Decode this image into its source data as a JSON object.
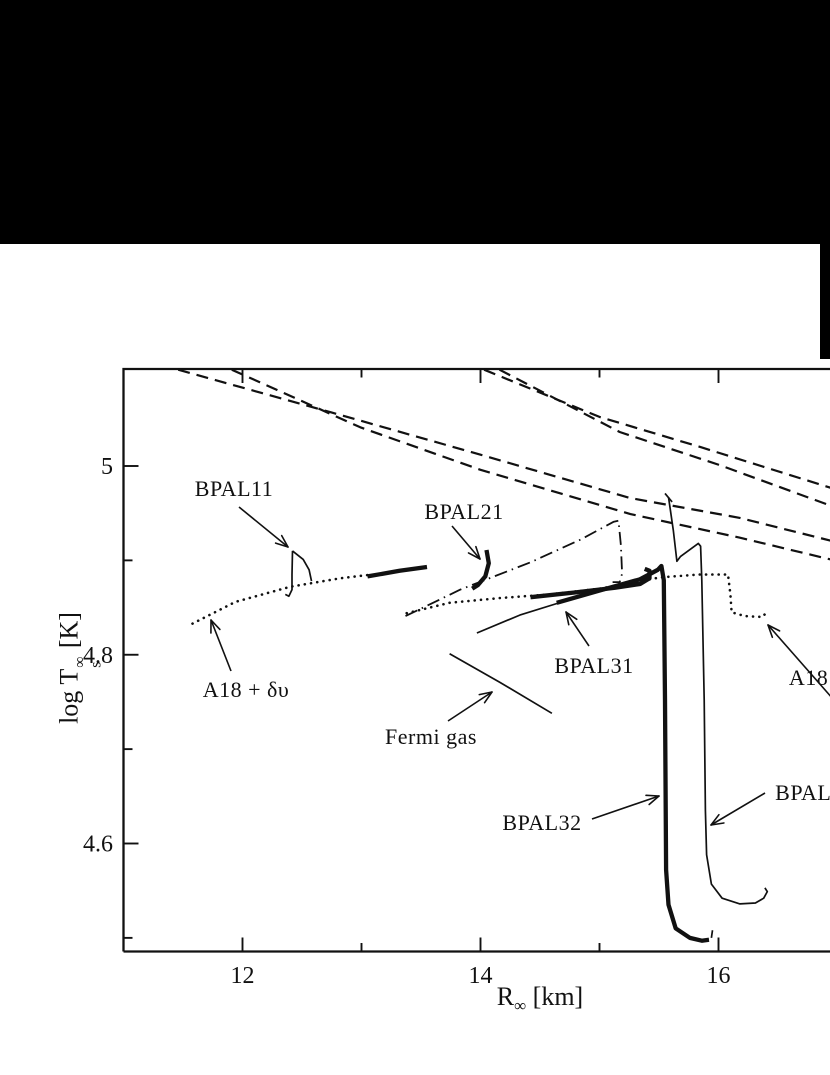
{
  "figure": {
    "background": "#ffffff",
    "ink_color": "#111111",
    "black_regions": [
      {
        "name": "top-black-banner",
        "x": 0,
        "y": 0,
        "w": 830,
        "h": 244
      },
      {
        "name": "right-black-strip",
        "x": 820,
        "y": 0,
        "w": 10,
        "h": 359
      }
    ]
  },
  "chart_data": {
    "type": "line",
    "title": "",
    "xlabel": {
      "main": "R",
      "sub": "∞",
      "rest": " [km]"
    },
    "ylabel": {
      "pre": "log T",
      "sup": "∞",
      "sub": "s",
      "rest": " [K]"
    },
    "x_range_visible": [
      10.97,
      16.95
    ],
    "y_range_visible": [
      4.49,
      5.1
    ],
    "grid": false,
    "legend": "none (arrowed in-plot annotations)",
    "axis_map": {
      "x": {
        "v1": 12,
        "px1": 242.5,
        "v2": 16,
        "px2": 718.5
      },
      "y": {
        "v1": 5.0,
        "py1": 466,
        "v2": 4.6,
        "py2": 843.5
      }
    },
    "frame": {
      "left_x": 123.5,
      "top_y": 369,
      "bottom_y": 951.5,
      "right_x": 833,
      "stroke_w": 2.3
    },
    "x_ticks": [
      {
        "label": "12",
        "r": 12,
        "major": true
      },
      {
        "label": "",
        "r": 13,
        "major": false
      },
      {
        "label": "14",
        "r": 14,
        "major": true
      },
      {
        "label": "",
        "r": 15,
        "major": false
      },
      {
        "label": "16",
        "r": 16,
        "major": true
      }
    ],
    "y_ticks": [
      {
        "label": "5",
        "t": 5.0,
        "major": true
      },
      {
        "label": "",
        "t": 4.9,
        "major": false
      },
      {
        "label": "4.8",
        "t": 4.8,
        "major": true
      },
      {
        "label": "",
        "t": 4.7,
        "major": false
      },
      {
        "label": "4.6",
        "t": 4.6,
        "major": true
      },
      {
        "label": "",
        "t": 4.5,
        "major": false
      }
    ],
    "styles": {
      "dashed": {
        "w": 2.2,
        "dash": "12 7"
      },
      "dotted": {
        "w": 2.6,
        "dash": "0.1 6.2",
        "cap": "round"
      },
      "dashdot": {
        "w": 1.8,
        "dash": "13 5 1.5 5"
      },
      "thick": {
        "w": 4.3
      },
      "thin": {
        "w": 1.7
      }
    },
    "series": [
      {
        "name": "dashed-upper-left-1",
        "style": "dashed",
        "segments": [
          [
            [
              11.46,
              5.102
            ],
            [
              12.74,
              5.057
            ],
            [
              14.0,
              5.012
            ],
            [
              15.26,
              4.966
            ],
            [
              16.18,
              4.945
            ],
            [
              16.94,
              4.921
            ]
          ]
        ]
      },
      {
        "name": "dashed-upper-left-2",
        "style": "dashed",
        "segments": [
          [
            [
              11.91,
              5.102
            ],
            [
              12.99,
              5.041
            ],
            [
              14.0,
              4.996
            ],
            [
              15.26,
              4.949
            ],
            [
              16.18,
              4.924
            ],
            [
              16.94,
              4.901
            ]
          ]
        ]
      },
      {
        "name": "dashed-upper-right-1",
        "style": "dashed",
        "segments": [
          [
            [
              14.03,
              5.102
            ],
            [
              15.0,
              5.052
            ],
            [
              15.85,
              5.02
            ],
            [
              16.94,
              4.977
            ]
          ]
        ]
      },
      {
        "name": "dashed-upper-right-2",
        "style": "dashed",
        "segments": [
          [
            [
              14.16,
              5.102
            ],
            [
              15.17,
              5.036
            ],
            [
              16.01,
              5.001
            ],
            [
              16.94,
              4.958
            ]
          ]
        ]
      },
      {
        "name": "a18-dv-dotted",
        "style": "dotted",
        "segments": [
          [
            [
              11.58,
              4.833
            ],
            [
              11.94,
              4.856
            ],
            [
              12.4,
              4.872
            ],
            [
              12.82,
              4.881
            ],
            [
              13.09,
              4.885
            ]
          ]
        ]
      },
      {
        "name": "thick-segment-13km",
        "style": "thick",
        "segments": [
          [
            [
              13.05,
              4.883
            ],
            [
              13.32,
              4.889
            ],
            [
              13.55,
              4.893
            ]
          ]
        ]
      },
      {
        "name": "bpal11-curve",
        "style": "thin",
        "segments": [
          [
            [
              12.42,
              4.91
            ],
            [
              12.416,
              4.885
            ],
            [
              12.416,
              4.869
            ],
            [
              12.39,
              4.862
            ],
            [
              12.36,
              4.864
            ]
          ],
          [
            [
              12.42,
              4.91
            ],
            [
              12.51,
              4.901
            ],
            [
              12.56,
              4.89
            ],
            [
              12.58,
              4.878
            ]
          ]
        ]
      },
      {
        "name": "bpal21-curve",
        "style": "thick",
        "segments": [
          [
            [
              14.05,
              4.911
            ],
            [
              14.07,
              4.897
            ],
            [
              14.04,
              4.883
            ],
            [
              13.98,
              4.874
            ],
            [
              13.93,
              4.87
            ]
          ]
        ]
      },
      {
        "name": "dash-dot-curve",
        "style": "dashdot",
        "segments": [
          [
            [
              13.37,
              4.841
            ],
            [
              13.83,
              4.869
            ],
            [
              14.42,
              4.898
            ],
            [
              14.84,
              4.922
            ],
            [
              15.12,
              4.941
            ],
            [
              15.16,
              4.942
            ],
            [
              15.18,
              4.916
            ],
            [
              15.19,
              4.886
            ],
            [
              15.17,
              4.877
            ],
            [
              15.11,
              4.877
            ]
          ]
        ]
      },
      {
        "name": "a18-dv-uix-dotted-stepped",
        "style": "dotted",
        "segments": [
          [
            [
              13.38,
              4.844
            ],
            [
              13.74,
              4.855
            ],
            [
              14.16,
              4.86
            ],
            [
              14.58,
              4.864
            ],
            [
              15.0,
              4.87
            ],
            [
              15.34,
              4.878
            ],
            [
              15.51,
              4.882
            ],
            [
              15.84,
              4.885
            ],
            [
              16.08,
              4.885
            ],
            [
              16.1,
              4.864
            ],
            [
              16.11,
              4.845
            ],
            [
              16.22,
              4.841
            ],
            [
              16.37,
              4.84
            ],
            [
              16.41,
              4.846
            ]
          ]
        ]
      },
      {
        "name": "bpal32-rise-thin",
        "style": "thin",
        "segments": [
          [
            [
              13.97,
              4.823
            ],
            [
              14.33,
              4.842
            ],
            [
              14.71,
              4.857
            ]
          ]
        ]
      },
      {
        "name": "bpal32-curve",
        "style": "thick",
        "segments": [
          [
            [
              14.64,
              4.855
            ],
            [
              15.0,
              4.868
            ],
            [
              15.34,
              4.88
            ],
            [
              15.49,
              4.89
            ],
            [
              15.52,
              4.894
            ],
            [
              15.54,
              4.879
            ],
            [
              15.55,
              4.752
            ],
            [
              15.56,
              4.572
            ],
            [
              15.58,
              4.535
            ],
            [
              15.64,
              4.51
            ],
            [
              15.76,
              4.5
            ],
            [
              15.86,
              4.497
            ],
            [
              15.92,
              4.498
            ]
          ]
        ]
      },
      {
        "name": "bpal32-end-tick",
        "style": "thin",
        "segments": [
          [
            [
              15.94,
              4.5
            ],
            [
              15.95,
              4.508
            ]
          ]
        ]
      },
      {
        "name": "bpal31-curve",
        "style": "thick",
        "segments": [
          [
            [
              14.42,
              4.861
            ],
            [
              14.79,
              4.866
            ],
            [
              15.13,
              4.871
            ],
            [
              15.34,
              4.875
            ],
            [
              15.42,
              4.881
            ],
            [
              15.42,
              4.889
            ],
            [
              15.38,
              4.891
            ]
          ]
        ]
      },
      {
        "name": "bpal33-curve",
        "style": "thin",
        "segments": [
          [
            [
              15.58,
              4.967
            ],
            [
              15.62,
              4.932
            ],
            [
              15.65,
              4.899
            ],
            [
              15.68,
              4.904
            ],
            [
              15.83,
              4.918
            ],
            [
              15.85,
              4.915
            ],
            [
              15.86,
              4.879
            ],
            [
              15.88,
              4.752
            ],
            [
              15.89,
              4.635
            ],
            [
              15.9,
              4.588
            ],
            [
              15.94,
              4.557
            ],
            [
              16.03,
              4.542
            ],
            [
              16.18,
              4.536
            ],
            [
              16.31,
              4.537
            ],
            [
              16.38,
              4.542
            ],
            [
              16.41,
              4.549
            ],
            [
              16.39,
              4.553
            ]
          ],
          [
            [
              15.55,
              4.971
            ],
            [
              15.61,
              4.962
            ]
          ]
        ]
      },
      {
        "name": "fermi-gas-curve",
        "style": "thin",
        "segments": [
          [
            [
              13.74,
              4.801
            ],
            [
              14.16,
              4.771
            ],
            [
              14.6,
              4.738
            ]
          ]
        ]
      }
    ],
    "annotations": [
      {
        "id": "bpal11",
        "text": "BPAL11",
        "tx": 234,
        "ty": 489,
        "ax1": 239,
        "ay1": 507,
        "ax2": 288,
        "ay2": 547
      },
      {
        "id": "bpal21",
        "text": "BPAL21",
        "tx": 464,
        "ty": 512,
        "ax1": 452,
        "ay1": 526,
        "ax2": 480,
        "ay2": 559
      },
      {
        "id": "bpal31",
        "text": "BPAL31",
        "tx": 594,
        "ty": 666,
        "ax1": 589,
        "ay1": 646,
        "ax2": 566,
        "ay2": 612
      },
      {
        "id": "bpal32",
        "text": "BPAL32",
        "tx": 542,
        "ty": 823,
        "ax1": 592,
        "ay1": 819,
        "ax2": 659,
        "ay2": 796
      },
      {
        "id": "bpal33",
        "text": "BPAL3",
        "tx": 809,
        "ty": 793,
        "ax1": 765,
        "ay1": 793,
        "ax2": 711,
        "ay2": 825
      },
      {
        "id": "a18-dv",
        "text": "A18 + δυ",
        "tx": 246,
        "ty": 690,
        "ax1": 231,
        "ay1": 671,
        "ax2": 211,
        "ay2": 620
      },
      {
        "id": "fermi-gas",
        "text": "Fermi gas",
        "tx": 431,
        "ty": 737,
        "ax1": 448,
        "ay1": 721,
        "ax2": 492,
        "ay2": 692
      },
      {
        "id": "a18-right",
        "text": "A18 +",
        "tx": 818,
        "ty": 678,
        "ax1": 848,
        "ay1": 716,
        "ax2": 768,
        "ay2": 625
      }
    ]
  }
}
